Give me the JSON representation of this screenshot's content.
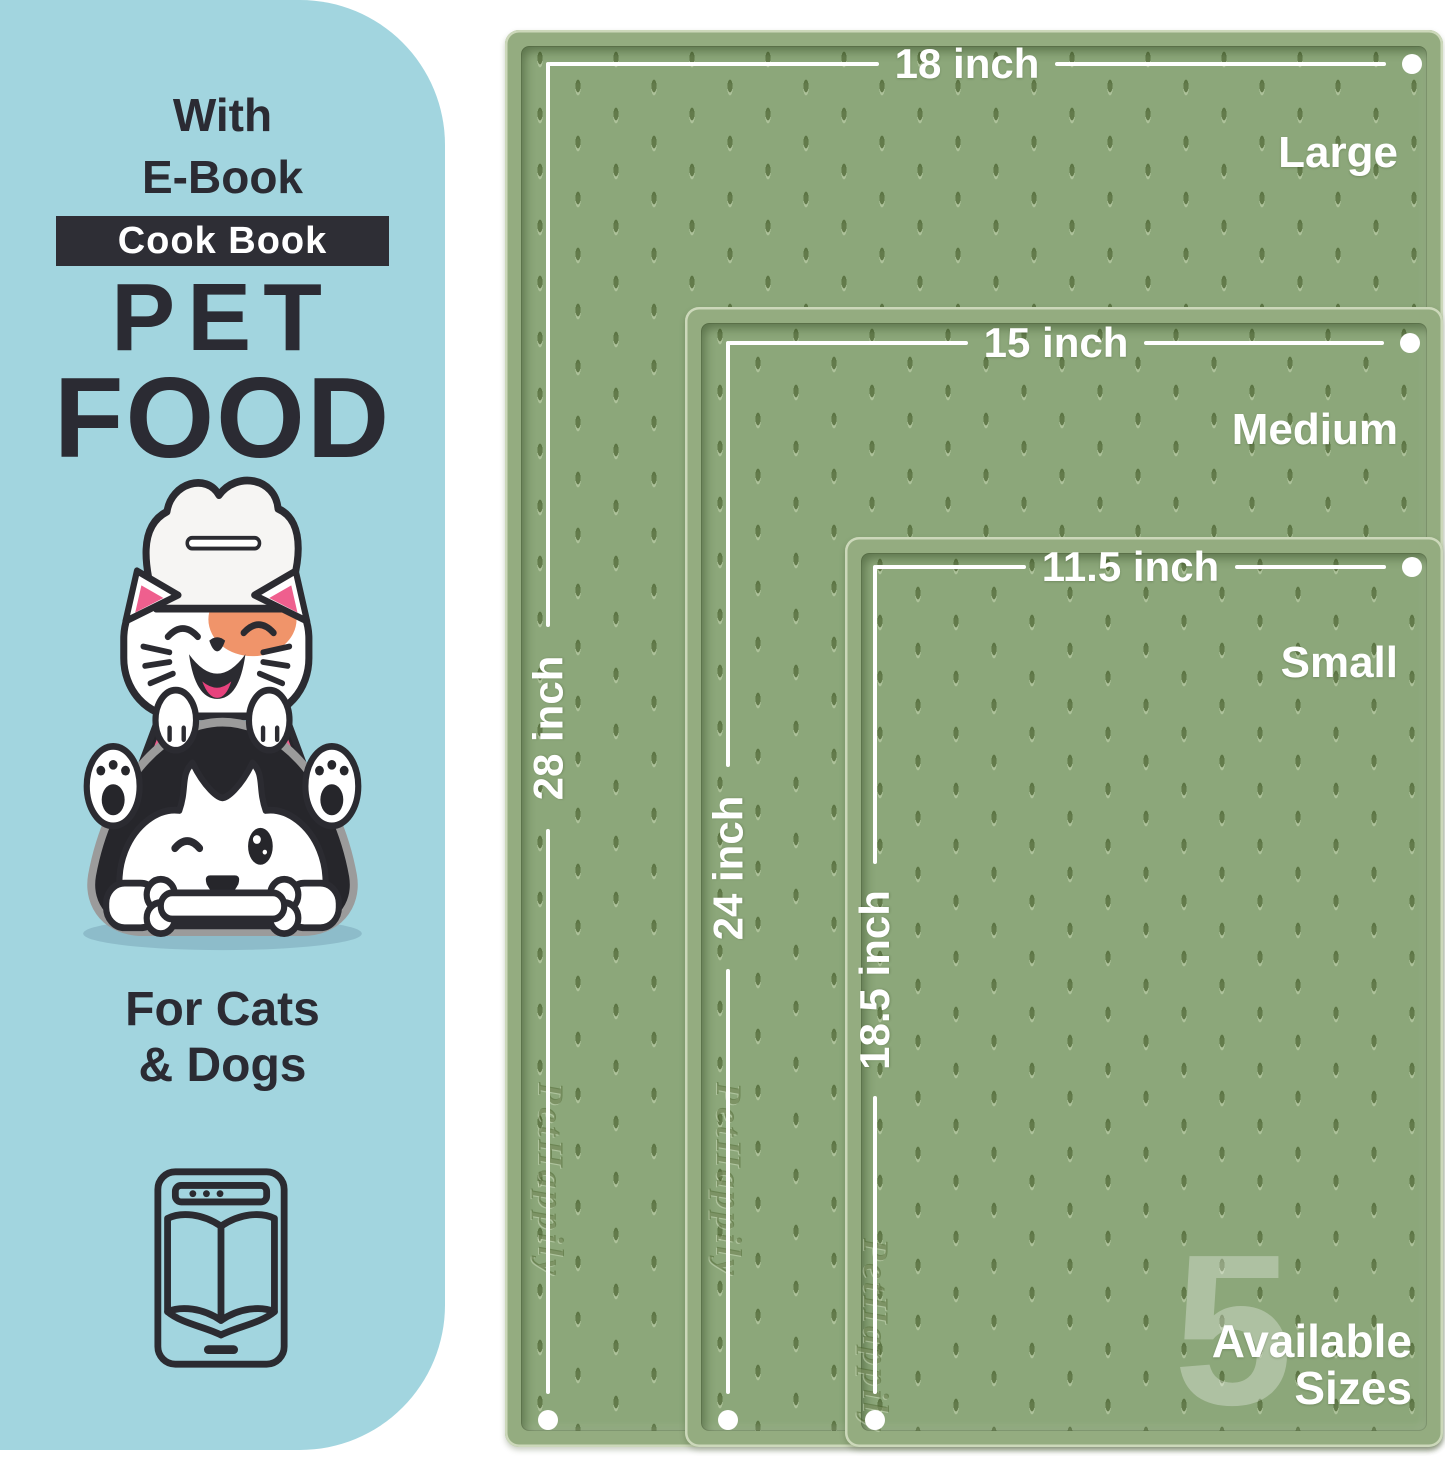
{
  "panel": {
    "line1": "With",
    "line2": "E-Book",
    "badge": "Cook Book",
    "title_line1": "PET",
    "title_line2": "FOOD",
    "subtitle_line1": "For Cats",
    "subtitle_line2": "& Dogs",
    "bg_color": "#a2d5df",
    "text_color": "#2b2b33",
    "badge_bg_color": "#2e2e35"
  },
  "mats": {
    "brand_emboss": "PetHappily",
    "surface_color": "#8ca77a",
    "rim_color": "#94ac80",
    "annotation_color": "#ffffff",
    "sizes": [
      {
        "name": "Large",
        "width_label": "18 inch",
        "height_label": "28 inch"
      },
      {
        "name": "Medium",
        "width_label": "15 inch",
        "height_label": "24 inch"
      },
      {
        "name": "Small",
        "width_label": "11.5 inch",
        "height_label": "18.5 inch"
      }
    ]
  },
  "footer": {
    "big_number": "5",
    "caption_line1": "Available",
    "caption_line2": "Sizes"
  },
  "icons": {
    "illustration": "cat-chef-and-dog-with-bone",
    "ebook": "ebook-reader-open-book"
  }
}
